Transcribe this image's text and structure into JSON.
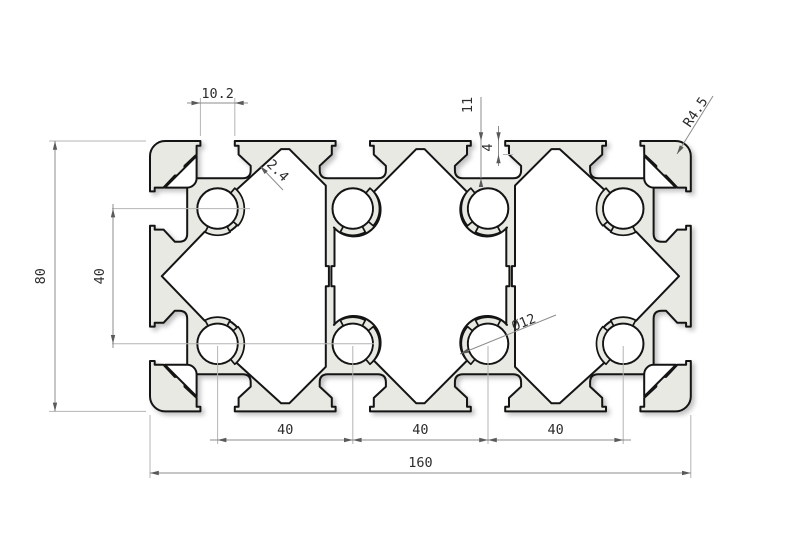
{
  "labels": {
    "slot_opening": "10.2",
    "slot_depth": "11",
    "slot_lip_height": "4",
    "wall_thickness": "2.4",
    "corner_radius": "R4.5",
    "center_hole_diameter": "Ø12",
    "profile_height": "80",
    "side_hole_pitch": "40",
    "bottom_pitches": [
      "40",
      "40",
      "40"
    ],
    "profile_width": "160"
  },
  "colors": {
    "aluminum_fill": "#e9e9e3",
    "outline": "#141414",
    "dimension_line": "#8c8c8c",
    "extension_line": "#b4b4b4",
    "text": "#2d2d2d"
  }
}
